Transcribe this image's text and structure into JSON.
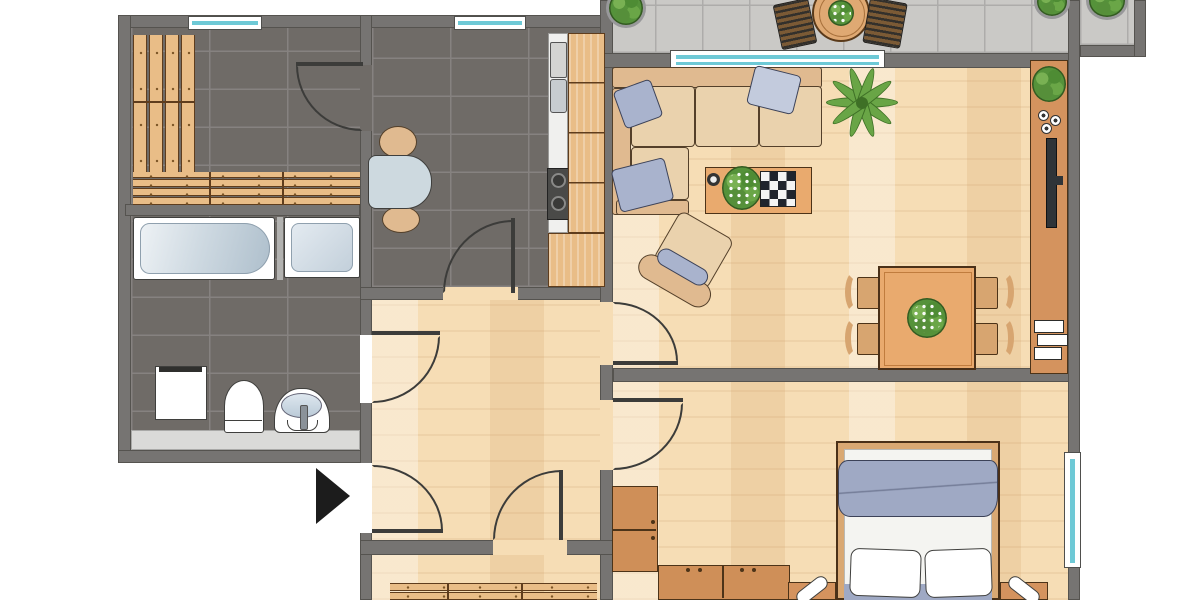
{
  "document": {
    "type": "apartment-floor-plan",
    "title": "Apartment floor plan, top-down architectural drawing",
    "orientation": "top-down"
  },
  "colors": {
    "wall": "#767472",
    "wallEdge": "#55534f",
    "tileDark": "#6f6b67",
    "tileGrout": "#868280",
    "wood": "#f6ddb5",
    "balconyTile": "#cac9c6",
    "balconyGrout": "#adacaa",
    "windowTeal": "#6ec9d6",
    "furnWood": "#e9bd87",
    "furnWoodEdge": "#5f3d1d",
    "furnOrange": "#d4935e",
    "tableOrange": "#e9aa6e",
    "sofaFrame": "#e0ba90",
    "cushion": "#ead2ad",
    "outline": "#54402a",
    "pillowBlue": "#a9b3cd",
    "blanketBlue": "#9fa9c4",
    "chairWood": "#d7a570",
    "fixtureWhite": "#ffffff",
    "basinBlue": "#ccd8e2",
    "steel": "#c9c9c7",
    "stoveDark": "#4a4a48",
    "tvDark": "#2f3438",
    "matGray": "#dadad8",
    "tabletopGray": "#cdd9df",
    "arcCol": "#3c3c3a",
    "arrowBlack": "#1c1c1c"
  },
  "rooms": [
    {
      "id": "utility-room",
      "floor": "dark-tile",
      "features": [
        "slatted-wall-benches",
        "window",
        "door"
      ]
    },
    {
      "id": "bathroom",
      "floor": "dark-tile",
      "features": [
        "bathtub",
        "shower",
        "washing-machine",
        "toilet",
        "sink",
        "mat"
      ]
    },
    {
      "id": "kitchen",
      "floor": "dark-tile",
      "features": [
        "window",
        "counter",
        "sink-unit",
        "stove",
        "small-table",
        "two-chairs"
      ]
    },
    {
      "id": "hallway",
      "floor": "wood",
      "features": [
        "entrance-door",
        "doors-to-all-rooms"
      ]
    },
    {
      "id": "living-room",
      "floor": "wood",
      "features": [
        "corner-sofa",
        "throw-pillows",
        "coffee-table",
        "armchair",
        "palm-plant",
        "dining-table",
        "four-chairs",
        "sideboard",
        "tv",
        "books",
        "balcony-window"
      ]
    },
    {
      "id": "bedroom",
      "floor": "wood",
      "features": [
        "double-bed",
        "blanket",
        "pillows",
        "two-nightstands",
        "two-lamps",
        "wardrobe",
        "window"
      ]
    },
    {
      "id": "lower-room",
      "floor": "wood",
      "features": [
        "slatted-benches"
      ]
    },
    {
      "id": "balcony",
      "floor": "gray-tile",
      "features": [
        "round-table",
        "two-slat-chairs",
        "three-potted-plants"
      ]
    },
    {
      "id": "neighbor-balcony",
      "floor": "gray-tile",
      "features": [
        "potted-plant"
      ]
    }
  ],
  "entrance": {
    "symbol": "black-arrow",
    "direction": "right"
  }
}
